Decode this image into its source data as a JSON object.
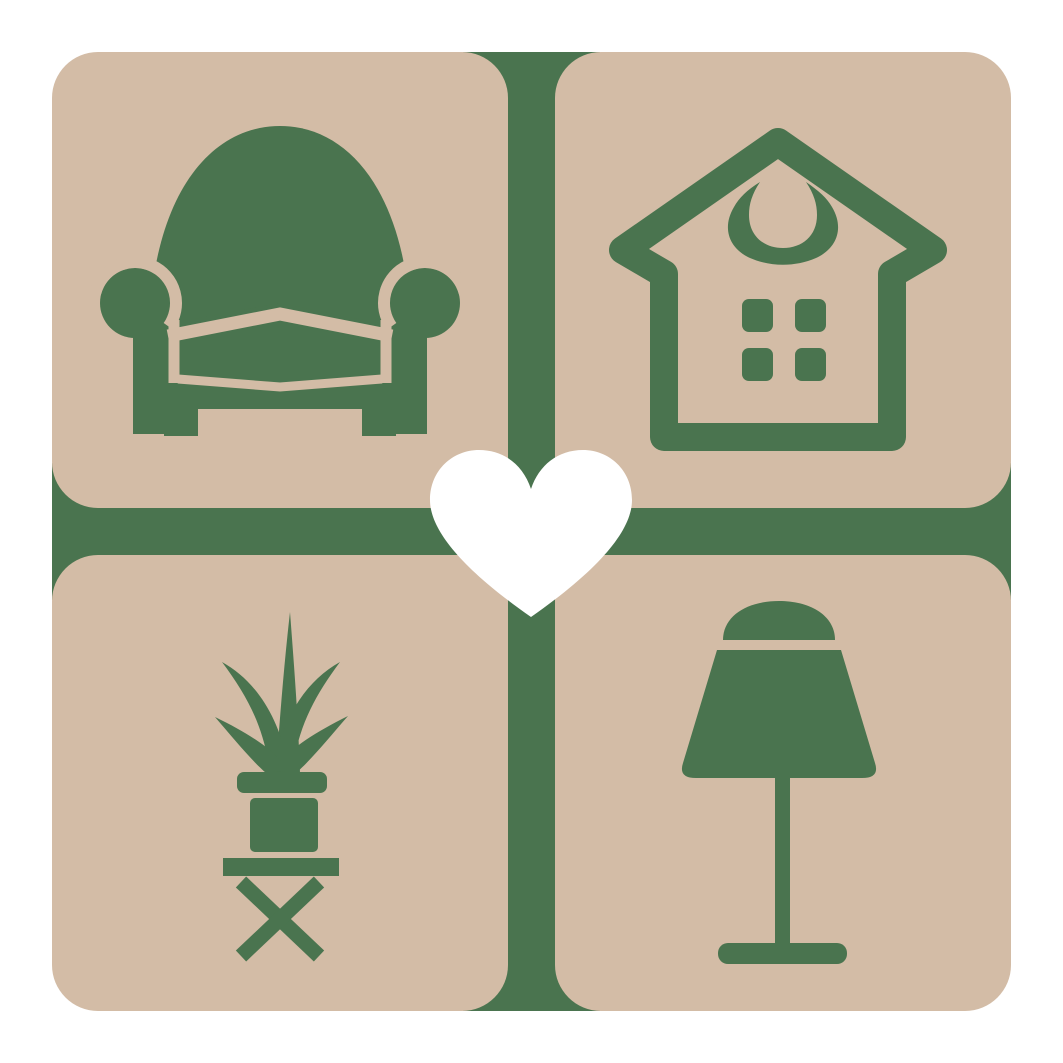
{
  "colors": {
    "background": "#ffffff",
    "tile": "#d3bca6",
    "accent": "#4a744f",
    "heart": "#ffffff"
  },
  "logo": {
    "type": "home-and-furniture-logo",
    "grid": "2x2 rounded tiles divided by green cross",
    "tiles": [
      {
        "position": "top-left",
        "icon": "armchair-icon"
      },
      {
        "position": "top-right",
        "icon": "house-icon"
      },
      {
        "position": "bottom-left",
        "icon": "potted-plant-icon"
      },
      {
        "position": "bottom-right",
        "icon": "table-lamp-icon"
      }
    ],
    "center_icon": "heart-icon"
  }
}
